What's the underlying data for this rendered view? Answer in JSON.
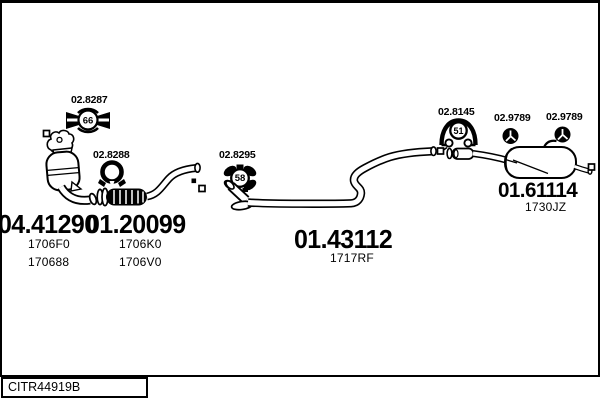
{
  "page": {
    "background": "#ffffff",
    "line_color": "#000000"
  },
  "parts": {
    "catalytic": {
      "number": "04.41290",
      "codes": [
        "1706F0",
        "170688"
      ]
    },
    "front_pipe": {
      "number": "01.20099",
      "codes": [
        "1706K0",
        "1706V0"
      ]
    },
    "center_pipe": {
      "number": "01.43112",
      "codes": [
        "1717RF"
      ]
    },
    "rear_muffler": {
      "number": "01.61114",
      "codes": [
        "1730JZ"
      ]
    }
  },
  "fittings": {
    "gasket_a": {
      "number": "02.8287",
      "badge": "66"
    },
    "clamp": {
      "number": "02.8288"
    },
    "gasket_b": {
      "number": "02.8295",
      "badge": "58"
    },
    "gasket_c": {
      "number": "02.8145",
      "badge": "51"
    },
    "mount_a": {
      "number": "02.9789"
    },
    "mount_b": {
      "number": "02.9789"
    }
  },
  "footer": {
    "code": "CITR44919B"
  }
}
